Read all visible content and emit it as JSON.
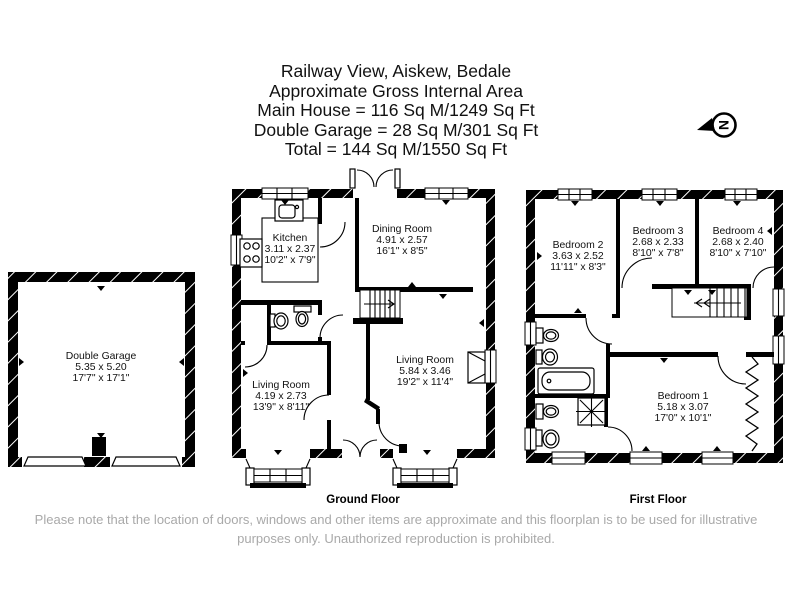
{
  "title": {
    "lines": [
      "Railway View, Aiskew, Bedale",
      "Approximate Gross Internal Area",
      "Main House = 116 Sq M/1249 Sq Ft",
      "Double Garage = 28 Sq M/301 Sq Ft",
      "Total = 144 Sq M/1550 Sq Ft"
    ]
  },
  "compass": {
    "letter": "N"
  },
  "plans": {
    "garage": {
      "rooms": [
        {
          "name": "Double Garage",
          "metric": "5.35 x 5.20",
          "imperial": "17'7\" x 17'1\""
        }
      ]
    },
    "ground": {
      "label": "Ground Floor",
      "rooms": [
        {
          "name": "Kitchen",
          "metric": "3.11 x 2.37",
          "imperial": "10'2\" x 7'9\""
        },
        {
          "name": "Dining Room",
          "metric": "4.91 x 2.57",
          "imperial": "16'1\" x 8'5\""
        },
        {
          "name": "Living Room",
          "metric": "4.19 x 2.73",
          "imperial": "13'9\" x 8'11\""
        },
        {
          "name": "Living Room",
          "metric": "5.84 x 3.46",
          "imperial": "19'2\" x 11'4\""
        }
      ]
    },
    "first": {
      "label": "First Floor",
      "rooms": [
        {
          "name": "Bedroom 2",
          "metric": "3.63 x 2.52",
          "imperial": "11'11\" x 8'3\""
        },
        {
          "name": "Bedroom 3",
          "metric": "2.68 x 2.33",
          "imperial": "8'10\" x 7'8\""
        },
        {
          "name": "Bedroom 4",
          "metric": "2.68 x 2.40",
          "imperial": "8'10\" x 7'10\""
        },
        {
          "name": "Bedroom 1",
          "metric": "5.18 x 3.07",
          "imperial": "17'0\" x 10'1\""
        }
      ]
    }
  },
  "footer": {
    "line1": "Please note that the location of doors, windows and other items are approximate and this floorplan is to be used for illustrative",
    "line2": "purposes only. Unauthorized reproduction is prohibited."
  }
}
